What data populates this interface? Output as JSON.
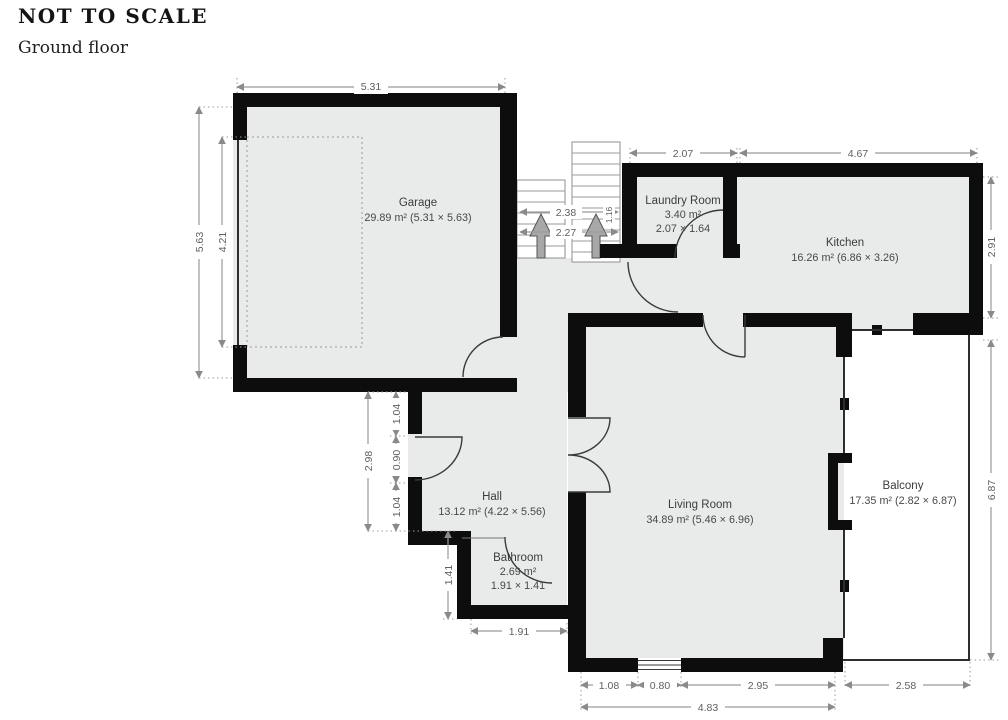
{
  "header": {
    "title": "NOT TO SCALE",
    "floor_label": "Ground floor"
  },
  "rooms": {
    "garage": {
      "name": "Garage",
      "area": "29.89 m² (5.31 × 5.63)"
    },
    "laundry": {
      "name": "Laundry Room",
      "area": "3.40 m²",
      "size": "2.07 × 1.64"
    },
    "kitchen": {
      "name": "Kitchen",
      "area": "16.26 m² (6.86 × 3.26)"
    },
    "hall": {
      "name": "Hall",
      "area": "13.12 m² (4.22 × 5.56)"
    },
    "bathroom": {
      "name": "Bathroom",
      "area": "2.69 m²",
      "size": "1.91 × 1.41"
    },
    "living_room": {
      "name": "Living Room",
      "area": "34.89 m² (5.46 × 6.96)"
    },
    "balcony": {
      "name": "Balcony",
      "area": "17.35 m² (2.82 × 6.87)"
    }
  },
  "dims": {
    "garage_width": "5.31",
    "garage_depth": "5.63",
    "garage_inner_depth": "4.21",
    "stairs_a": "2.38",
    "stairs_b": "2.27",
    "stairs_width": "1.16",
    "laundry_width": "2.07",
    "kitchen_width": "4.67",
    "kitchen_depth": "2.91",
    "hall_depth": "2.98",
    "hall_seg_top": "1.04",
    "hall_door": "0.90",
    "hall_seg_bottom": "1.04",
    "bathroom_depth": "1.41",
    "bathroom_width": "1.91",
    "lr_seg1": "1.08",
    "lr_window": "0.80",
    "lr_seg2": "2.95",
    "lr_total": "4.83",
    "balcony_width": "2.58",
    "balcony_depth": "6.87"
  },
  "colors": {
    "wall": "#0d0d0d",
    "floor": "#e9eaea",
    "dimension": "#9a9a9a",
    "label": "#3c3c3c"
  }
}
